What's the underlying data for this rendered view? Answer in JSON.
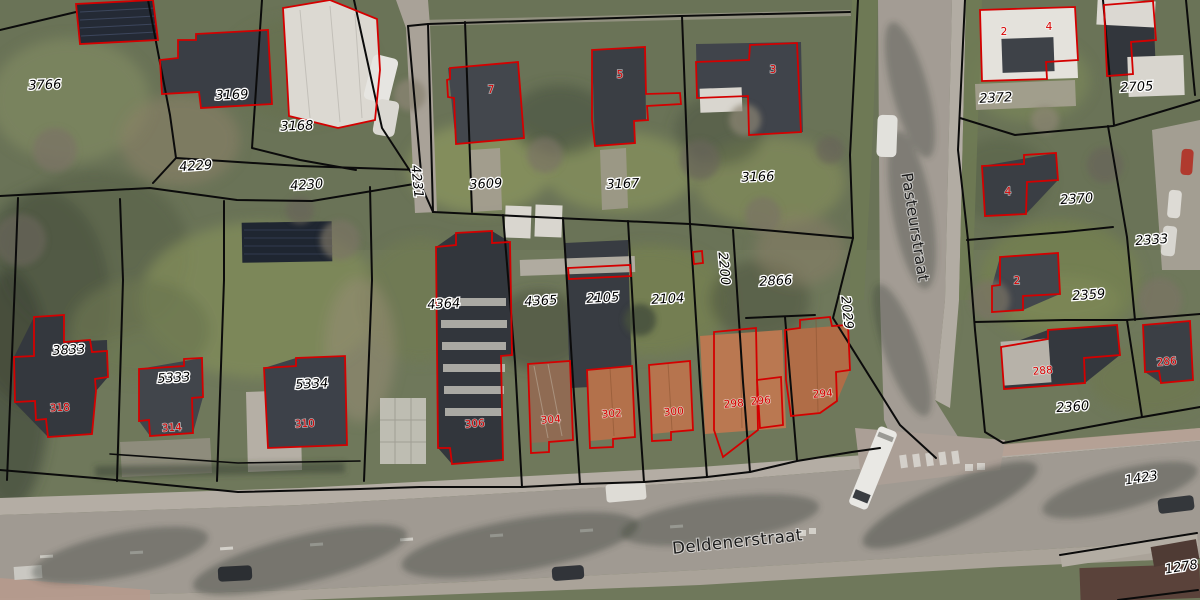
{
  "map": {
    "street_names": [
      "Pasteurstraat",
      "Deldenerstraat"
    ],
    "parcel_numbers": [
      "3766",
      "3169",
      "3168",
      "4229",
      "4230",
      "4231",
      "3609",
      "3167",
      "3166",
      "2372",
      "2705",
      "2370",
      "2333",
      "2359",
      "2360",
      "3833",
      "5333",
      "5334",
      "4364",
      "4365",
      "2105",
      "2104",
      "2200",
      "2866",
      "2029",
      "1423",
      "1278"
    ],
    "house_numbers": [
      "7",
      "5",
      "3",
      "2",
      "4",
      "4",
      "2",
      "318",
      "314",
      "310",
      "306",
      "304",
      "302",
      "300",
      "298",
      "296",
      "294",
      "288",
      "286"
    ]
  },
  "colors": {
    "parcel_line": "#0b0b0b",
    "building_outline": "#d40000",
    "parcel_text": "#000000",
    "house_text": "#d80000",
    "street_text": "#1c1c1c"
  }
}
